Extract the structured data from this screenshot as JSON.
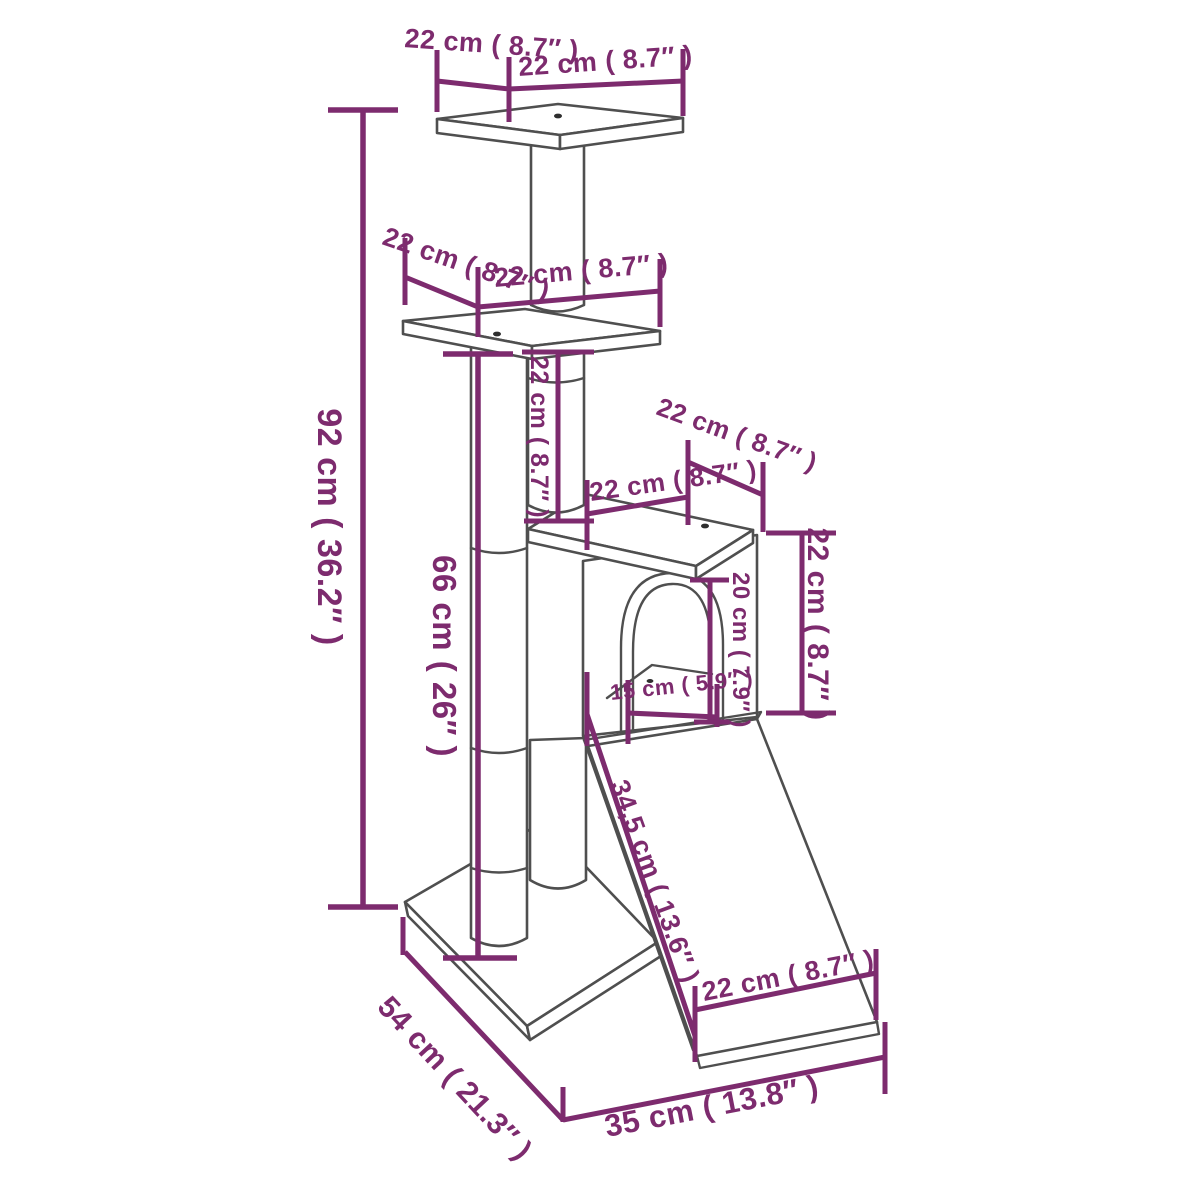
{
  "colors": {
    "dimension_accent": "#7d2b6e",
    "outline_gray": "#4f4f4f",
    "background": "#ffffff"
  },
  "labels": {
    "total_height": "92 cm ( 36.2″ )",
    "main_post_height": "66 cm ( 26″ )",
    "top_platform_depth": "22 cm ( 8.7″ )",
    "top_platform_width": "22 cm ( 8.7″ )",
    "middle_platform_depth": "22 cm ( 8.7″ )",
    "middle_platform_width": "22 cm ( 8.7″ )",
    "upper_post_height": "22 cm ( 8.7″ )",
    "house_roof_depth": "22 cm ( 8.7″ )",
    "house_roof_width": "22 cm ( 8.7″ )",
    "house_height": "22 cm ( 8.7″ )",
    "door_height": "20 cm ( 7.9″ )",
    "door_width": "15 cm ( 5.9″ )",
    "ramp_length": "34,5 cm ( 13.6″ )",
    "ramp_width": "22 cm ( 8.7″ )",
    "base_depth": "54 cm ( 21.3″ )",
    "base_width": "35 cm ( 13.8″ )"
  }
}
